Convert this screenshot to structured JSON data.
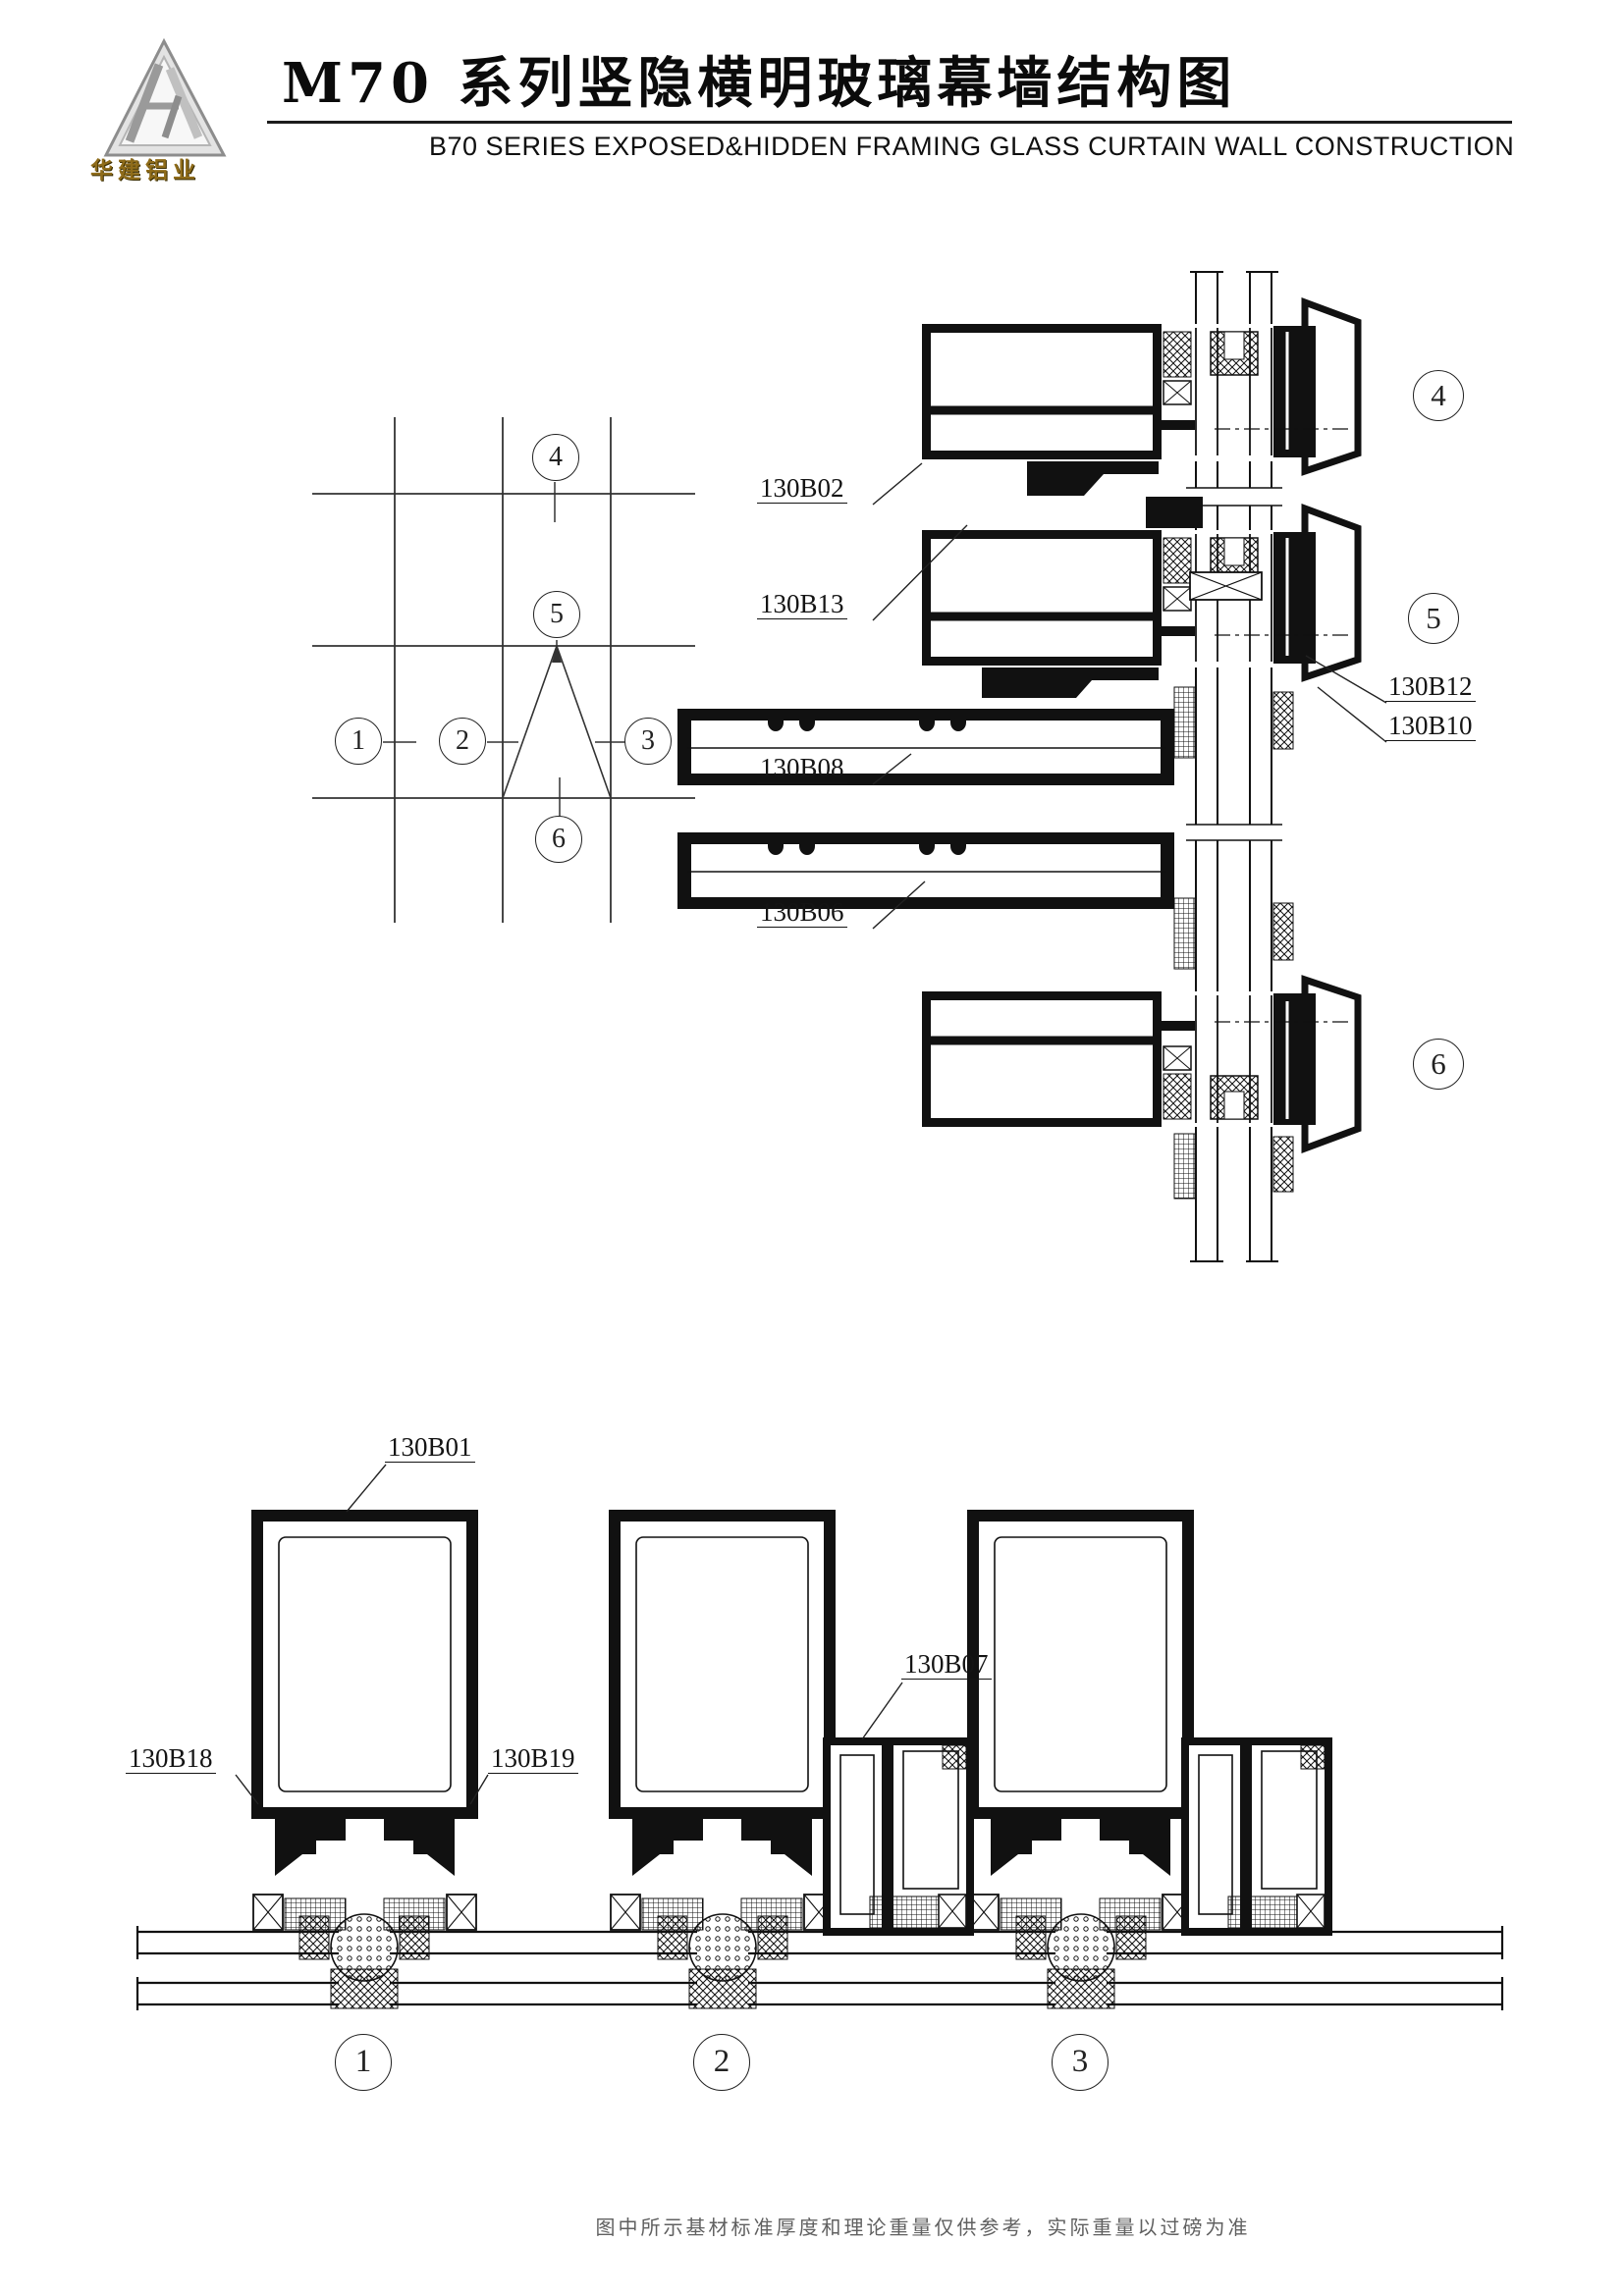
{
  "colors": {
    "line": "#111111",
    "paper": "#ffffff",
    "brand_gold": "#8f6c1a"
  },
  "header": {
    "logo_icon": "hj-triangle-logo",
    "brand": "华建铝业",
    "title": "M70 系列竖隐横明玻璃幕墙结构图",
    "subtitle": "B70  SERIES EXPOSED&HIDDEN FRAMING GLASS CURTAIN WALL CONSTRUCTION"
  },
  "key_plan": {
    "circle_numbers": {
      "k1": "1",
      "k2": "2",
      "k3": "3",
      "k4": "4",
      "k5": "5",
      "k6": "6"
    }
  },
  "details": {
    "part_labels": {
      "b01": "130B01",
      "b02": "130B02",
      "b06": "130B06",
      "b07": "130B07",
      "b08": "130B08",
      "b10": "130B10",
      "b12": "130B12",
      "b13": "130B13",
      "b18": "130B18",
      "b19": "130B19"
    },
    "circle_numbers": {
      "d1": "1",
      "d2": "2",
      "d3": "3",
      "d4": "4",
      "d5": "5",
      "d6": "6"
    }
  },
  "footer": {
    "note": "图中所示基材标准厚度和理论重量仅供参考，实际重量以过磅为准"
  }
}
